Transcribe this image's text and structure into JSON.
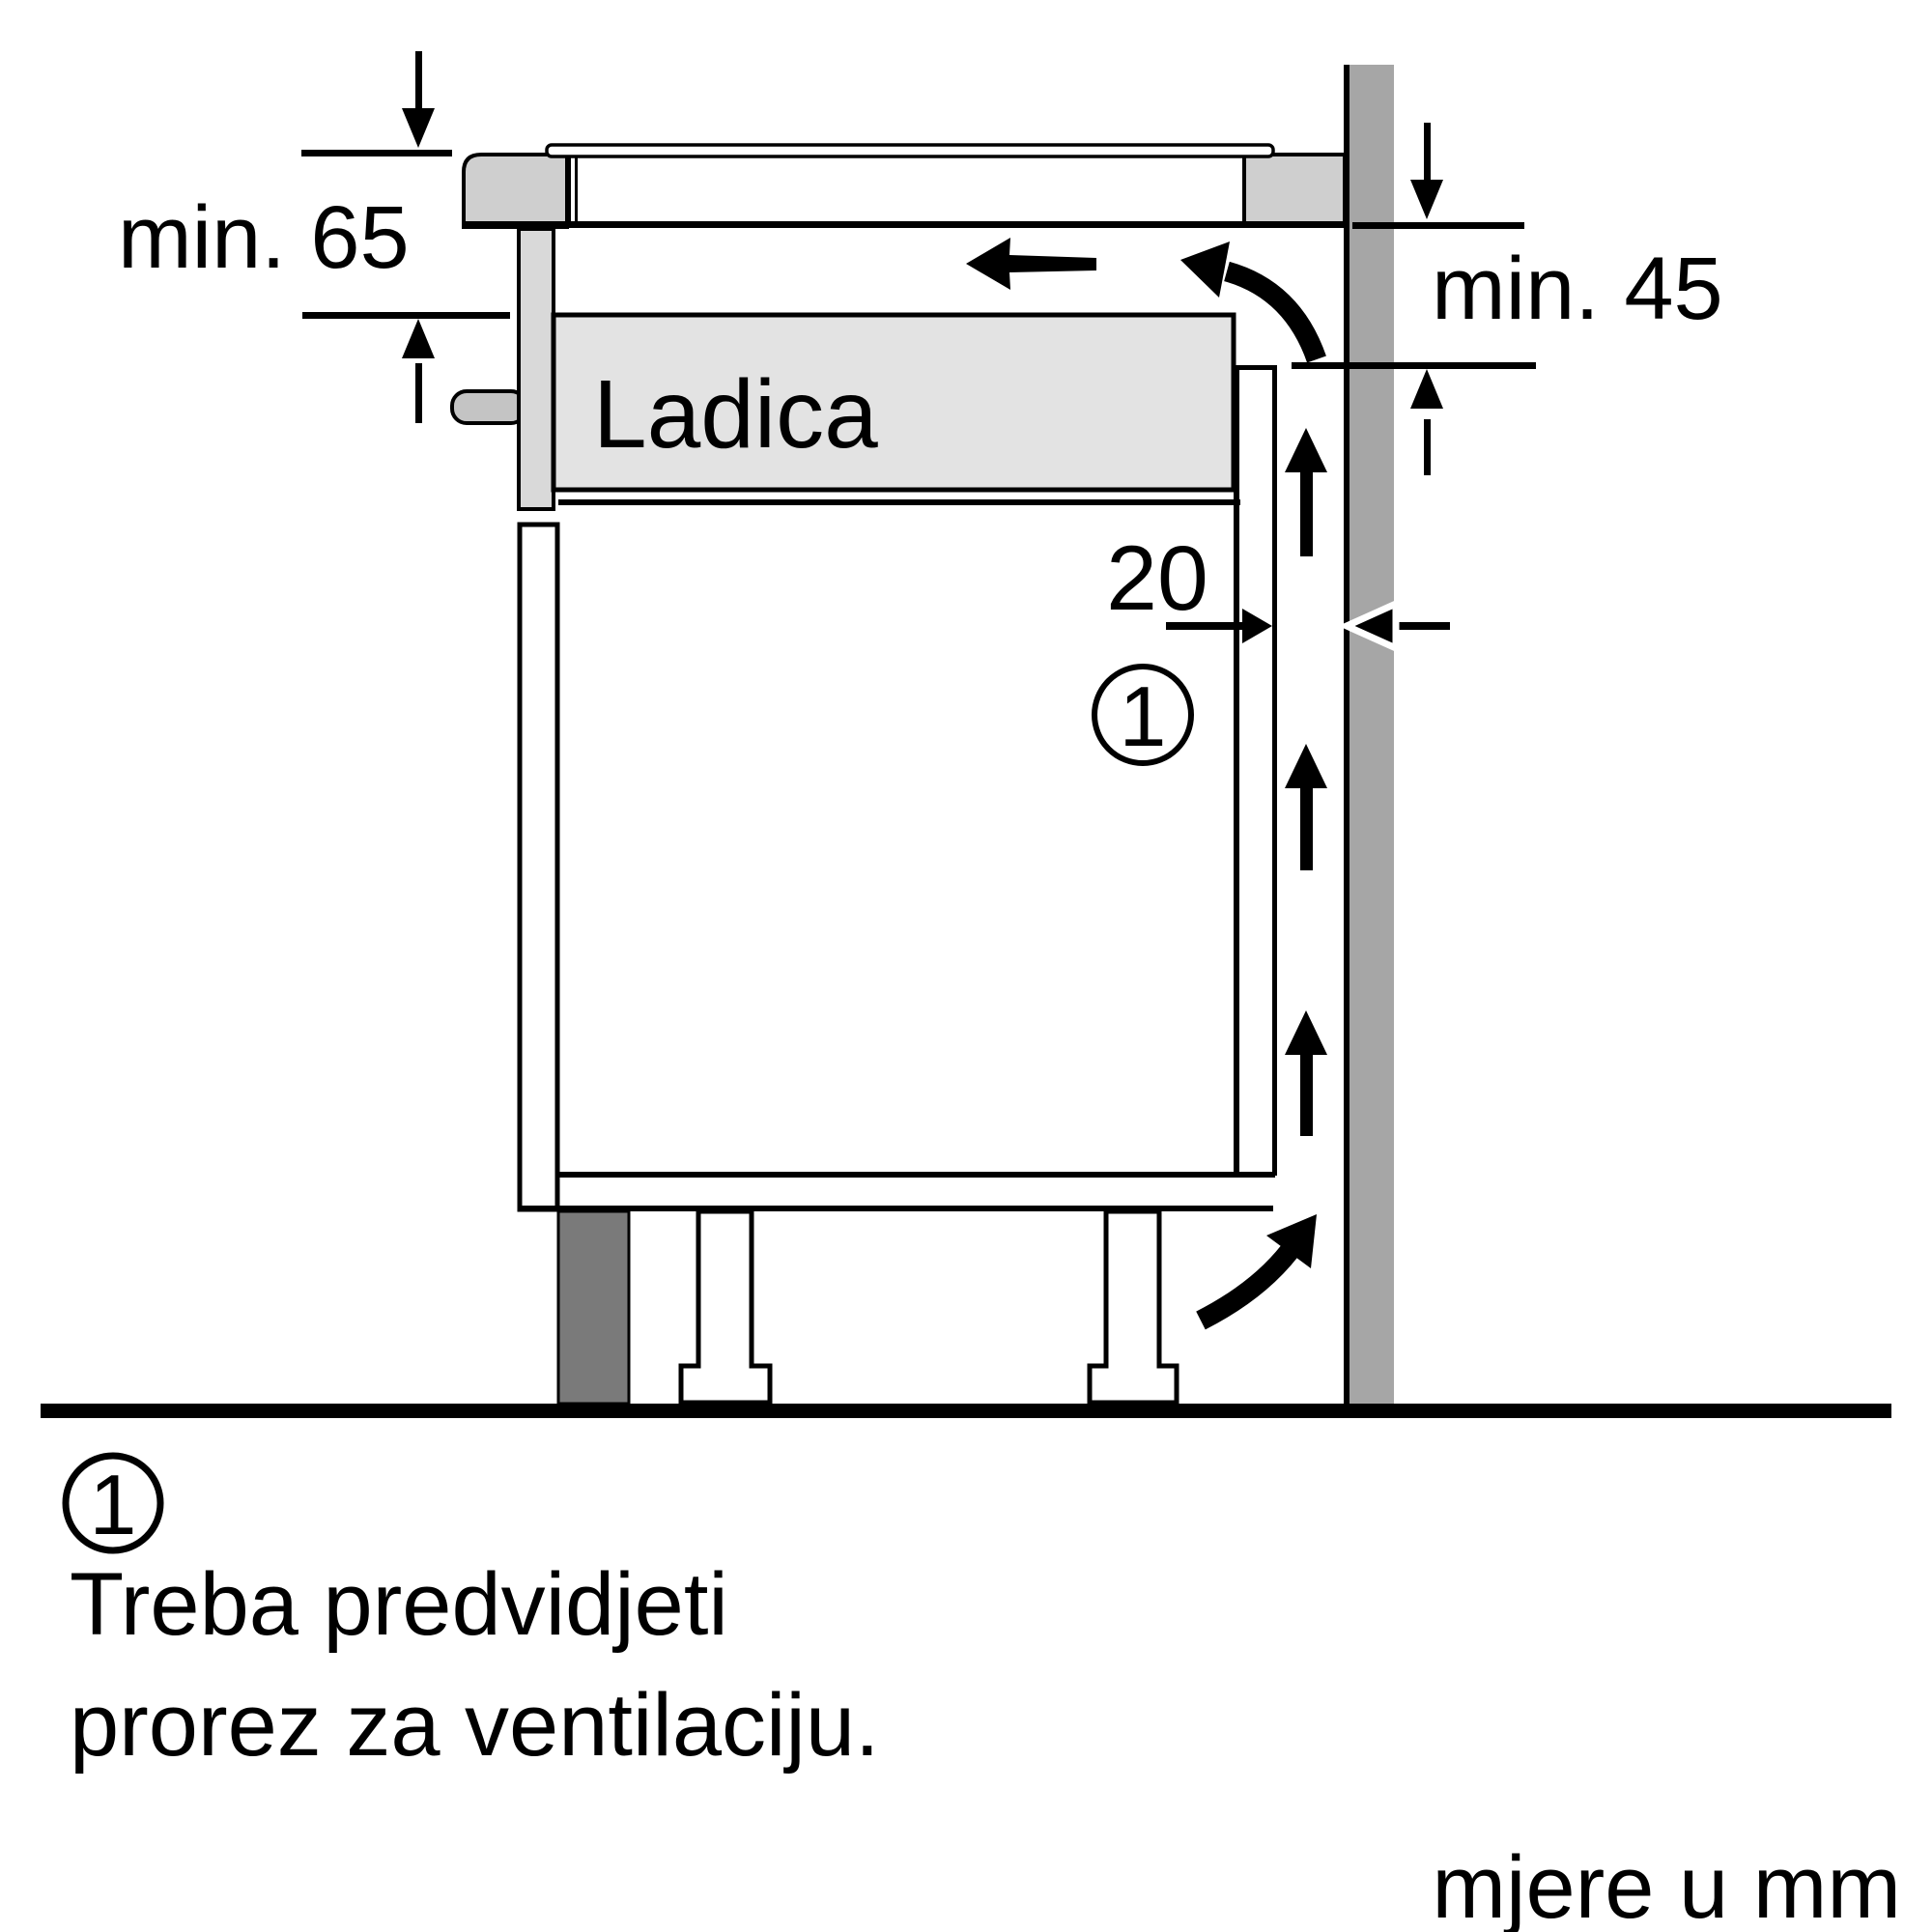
{
  "diagram": {
    "title_hint": "appliance-installation-side-view",
    "labels": {
      "dim_left": "min. 65",
      "dim_right": "min. 45",
      "dim_gap": "20",
      "drawer": "Ladica",
      "callout_number": "1",
      "units_note": "mjere u mm"
    },
    "footnote": {
      "number": "1",
      "line1": "Treba predvidjeti",
      "line2": "prorez za ventilaciju."
    },
    "colors": {
      "line": "#000000",
      "white": "#ffffff",
      "wall": "#a6a6a6",
      "counter_block": "#cfcfcf",
      "front_panel": "#d9d9d9",
      "screw": "#c4c4c4",
      "drawer_fill": "#e3e3e3",
      "plinth": "#7a7a7a"
    }
  }
}
